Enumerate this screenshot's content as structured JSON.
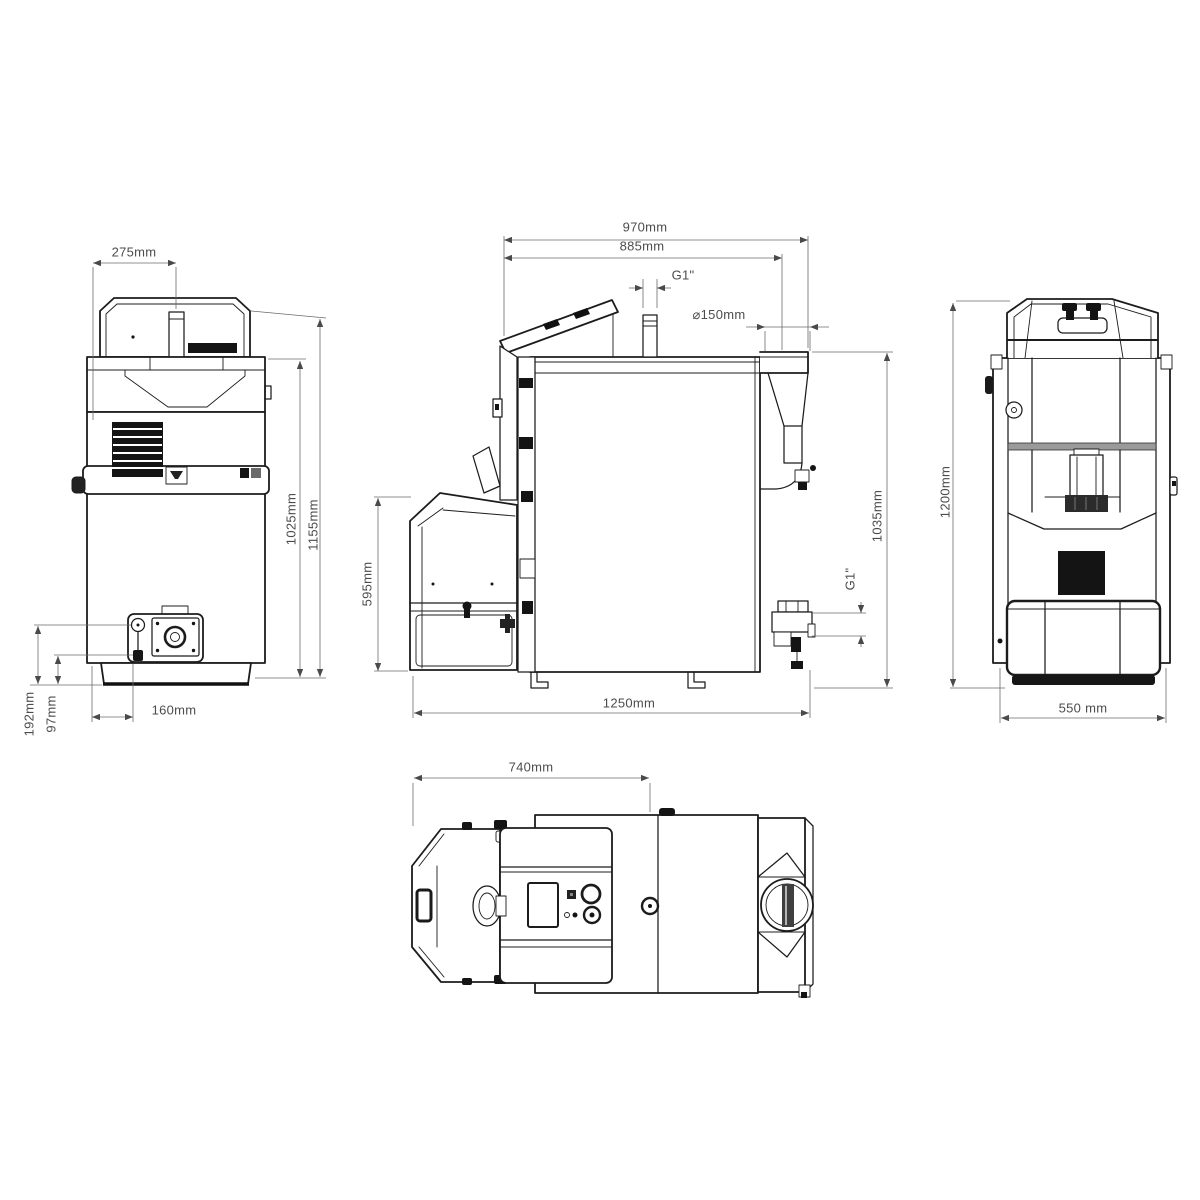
{
  "views": {
    "front": {
      "dims": {
        "top_width": "275mm",
        "body_height": "1025mm",
        "total_height": "1155mm",
        "burner_offset": "160mm",
        "burner_axis_height": "192mm",
        "drain_height": "97mm"
      }
    },
    "side": {
      "dims": {
        "depth_top": "970mm",
        "depth_body": "885mm",
        "flow_connection": "G1\"",
        "flue_diameter": "⌀150mm",
        "hopper_height": "595mm",
        "connection_height": "1035mm",
        "return_connection": "G1\"",
        "total_depth": "1250mm"
      }
    },
    "rear": {
      "dims": {
        "total_height": "1200mm",
        "width": "550 mm"
      }
    },
    "top": {
      "dims": {
        "front_width": "740mm"
      }
    }
  }
}
